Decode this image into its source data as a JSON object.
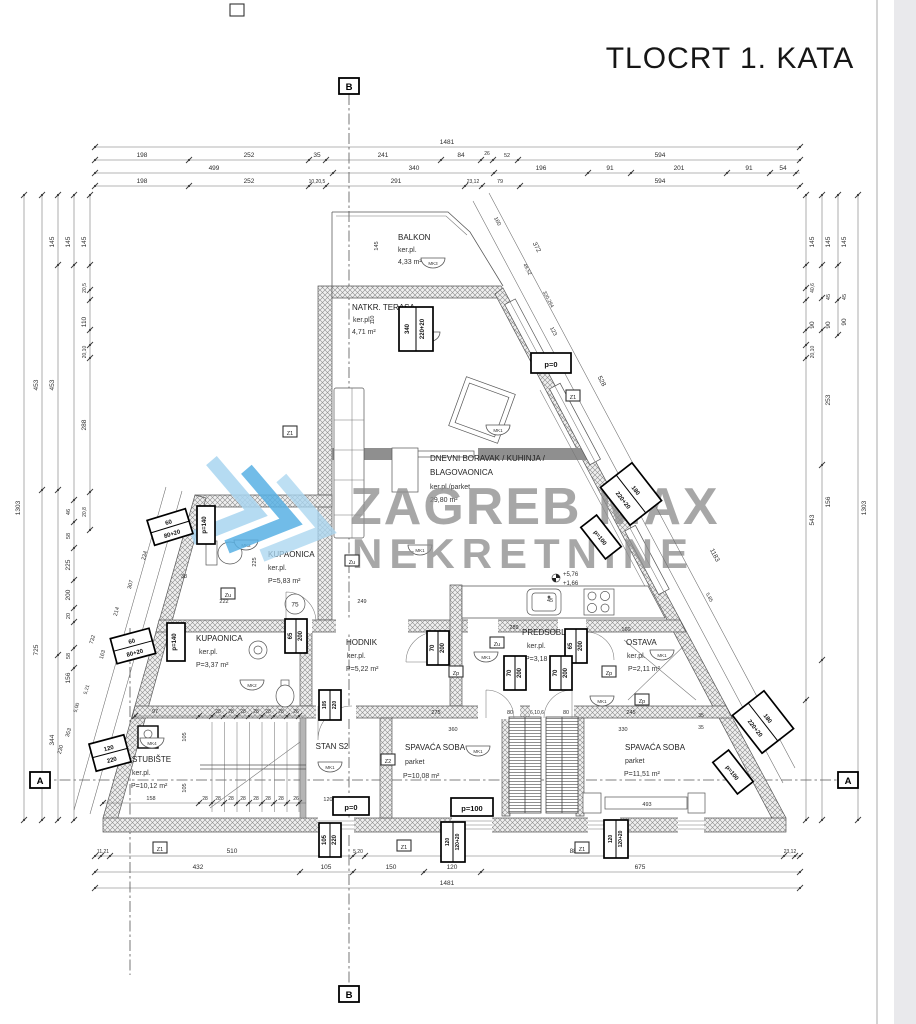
{
  "title": "TLOCRT 1. KATA",
  "watermark": {
    "line1": "ZAGREB MAX",
    "line2": "NEKRETNINE",
    "blue_dark": "#59b1e4",
    "blue_light": "#a9d5f0",
    "gray": "#8f8f8f"
  },
  "axis_markers": {
    "top": "B",
    "bottom": "B",
    "left": "A",
    "right": "A"
  },
  "unit_label": "STAN S2",
  "levels": {
    "upper": "+5,76",
    "lower": "+1,66"
  },
  "rooms": [
    {
      "name": "BALKON",
      "floor": "ker.pl.",
      "area": "4,33 m²"
    },
    {
      "name": "NATKR. TERASA",
      "floor": "ker.pl.",
      "area": "4,71 m²"
    },
    {
      "name": "DNEVNI BORAVAK / KUHINJA /",
      "name2": "BLAGOVAONICA",
      "floor": "ker.pl./parket",
      "area": "29,80 m²"
    },
    {
      "name": "KUPAONICA",
      "floor": "ker.pl.",
      "area": "P=5,83 m²"
    },
    {
      "name": "KUPAONICA",
      "floor": "ker.pl.",
      "area": "P=3,37 m²"
    },
    {
      "name": "HODNIK",
      "floor": "ker.pl.",
      "area": "P=5,22 m²"
    },
    {
      "name": "PREDSOBLJE",
      "floor": "ker.pl.",
      "area": "P=3,18 m²"
    },
    {
      "name": "OSTAVA",
      "floor": "ker.pl.",
      "area": "P=2,11 m²"
    },
    {
      "name": "SPAVAĆA SOBA",
      "floor": "parket",
      "area": "P=10,08 m²"
    },
    {
      "name": "SPAVAĆA SOBA",
      "floor": "parket",
      "area": "P=11,51 m²"
    },
    {
      "name": "STUBIŠTE",
      "floor": "ker.pl.",
      "area": "P=10,12 m²"
    }
  ],
  "fixtures": {
    "shower_d": "75",
    "sink_d": "45"
  },
  "mk_symbols": [
    "MK3",
    "MK3",
    "MK1",
    "MK1",
    "MK2",
    "MK1",
    "MK2",
    "MK4",
    "MK1",
    "MK1",
    "MK1",
    "MK1"
  ],
  "z_markers": [
    "Z1",
    "Zu",
    "Z1",
    "Zu",
    "Zu",
    "Zp",
    "Zp",
    "Zp",
    "Z2",
    "Z1",
    "Z1",
    "Z1"
  ],
  "dim_boxes": {
    "b340": [
      "340",
      "220+20"
    ],
    "p0a": [
      "p=0"
    ],
    "p0b": [
      "p=0"
    ],
    "p100a": [
      "p=100"
    ],
    "p100b": [
      "p=100"
    ],
    "p100c": [
      "p=100"
    ],
    "b180a": [
      "180",
      "220+20"
    ],
    "b180b": [
      "180",
      "220+20"
    ],
    "b60a": [
      "60",
      "80+20"
    ],
    "b60b": [
      "60",
      "80+20"
    ],
    "p140a": [
      "p=140"
    ],
    "p140b": [
      "p=140"
    ],
    "b120": [
      "120",
      "220"
    ],
    "b105a": [
      "105",
      "220"
    ],
    "b105b": [
      "105",
      "220"
    ],
    "b12020a": [
      "120",
      "120+20"
    ],
    "b12020b": [
      "120",
      "120+20"
    ],
    "b65a": [
      "65",
      "200"
    ],
    "b65b": [
      "65",
      "200"
    ],
    "b70a": [
      "70",
      "200"
    ],
    "b70b": [
      "70",
      "200"
    ],
    "b70c": [
      "70",
      "200"
    ]
  },
  "dims": {
    "top1": [
      "1481"
    ],
    "top2": [
      "198",
      "252",
      "35",
      "241",
      "84",
      "26",
      "52",
      "594"
    ],
    "top3": [
      "499",
      "340",
      "196",
      "91",
      "201",
      "91",
      "54"
    ],
    "top4": [
      "198",
      "252",
      "10,20,5",
      "291",
      "23,12",
      "79",
      "594"
    ],
    "bottom1": [
      "11,21",
      "510",
      "5,20",
      "880",
      "23,12"
    ],
    "bottom2": [
      "432",
      "105",
      "150",
      "120",
      "675"
    ],
    "bottom3": [
      "1481"
    ],
    "left1": [
      "1303"
    ],
    "left2": [
      "453",
      "725"
    ],
    "left3": [
      "145",
      "453",
      "344"
    ],
    "left4": [
      "145",
      "46",
      "58",
      "225",
      "200",
      "20",
      "58",
      "156"
    ],
    "left5": [
      "145",
      "20,5",
      "110",
      "20,10",
      "288",
      "20,8"
    ],
    "right1": [
      "145",
      "40,6",
      "90",
      "20,10",
      "543"
    ],
    "right2": [
      "145",
      "45",
      "90",
      "253",
      "156"
    ],
    "right3": [
      "145",
      "45",
      "90"
    ],
    "right4": [
      "1303"
    ],
    "diag_r_outer": [
      "372",
      "528",
      "1183"
    ],
    "diag_r_inner": [
      "160",
      "49,52",
      "320,294",
      "123",
      "5,85"
    ],
    "diag_l_outer": [
      "60",
      "234",
      "307",
      "214",
      "163"
    ],
    "diag_l_inner": [
      "732",
      "5,21",
      "5,00",
      "353",
      "230"
    ],
    "stairs_top": [
      "97",
      "28",
      "28",
      "28",
      "28",
      "28",
      "28",
      "26"
    ],
    "stairs_bottom": [
      "158",
      "28",
      "28",
      "28",
      "28",
      "28",
      "28",
      "28",
      "26"
    ],
    "stairs_side": [
      "105",
      "105"
    ],
    "interior": [
      "145",
      "110",
      "225",
      "38",
      "222",
      "249",
      "289",
      "160",
      "275",
      "360",
      "80",
      "6,10,6",
      "80",
      "245",
      "330",
      "35",
      "35",
      "493",
      "120"
    ]
  }
}
